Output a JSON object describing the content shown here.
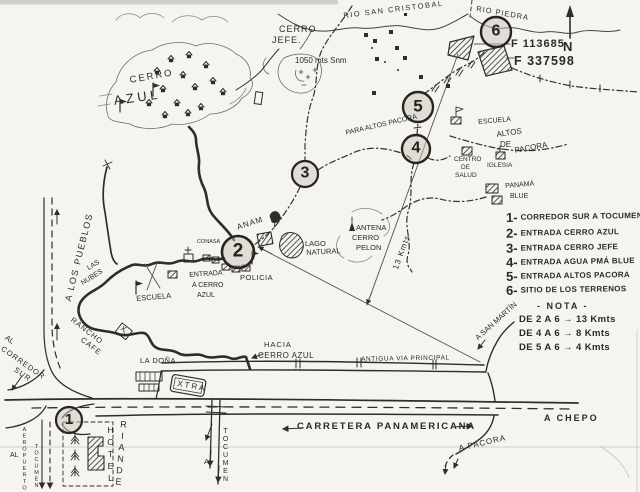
{
  "map": {
    "compass_n": "N",
    "rivers": {
      "rio_piedra": "RIO PIEDRA",
      "rio_san_cristobal": "RIO SAN CRISTOBAL"
    },
    "site": {
      "f1": "F 113685",
      "f2": "F 337598"
    },
    "markers": {
      "m1": "1",
      "m2": "2",
      "m3": "3",
      "m4": "4",
      "m5": "5",
      "m6": "6"
    },
    "places": {
      "cerro_jefe_1": "CERRO",
      "cerro_jefe_2": "JEFE.",
      "cerro_jefe_elev": "1050 mts Snm",
      "cerro_azul_1": "CERRO",
      "cerro_azul_2": "AZUL",
      "para_altos_pacora": "PARA ALTOS PACORA",
      "escuela_pacora": "ESCUELA",
      "altos_1": "ALTOS",
      "altos_2": "DE",
      "altos_3": "PACORA",
      "centro_1": "CENTRO",
      "centro_2": "DE",
      "centro_3": "SALUD",
      "iglesia": "IGLESIA",
      "panama_blue_1": "PANAMÁ",
      "panama_blue_2": "BLUE",
      "antena": "ANTENA",
      "cerro_pelon_1": "CERRO",
      "cerro_pelon_2": "PELON",
      "lago_1": "LAGO",
      "lago_2": "NATURAL",
      "anam": "ANAM",
      "conasa": "CONASA",
      "entrada_1": "ENTRADA",
      "entrada_2": "A CERRO",
      "entrada_3": "AZUL",
      "policia": "POLICIA",
      "las_nubes_1": "LAS",
      "las_nubes_2": "NUBES",
      "a_los_pueblos": "A LOS PUEBLOS",
      "rancho": "RANCHO",
      "cafe": "CAFE",
      "escuela_left": "ESCUELA",
      "hacia_1": "HACIA",
      "hacia_2": "CERRO AZUL",
      "antigua_via": "ANTIGUA VIA PRINCIPAL",
      "carretera": "CARRETERA PANAMERICANA",
      "la_dona": "LA DOÑA",
      "xtra": "XTRA",
      "a_san_martin": "A SAN MARTÍN",
      "a_chepo": "A CHEPO",
      "a_pacora": "A PACORA",
      "a_tocumen_a": "A",
      "a_tocumen": "TOCUMEN",
      "al_corredor_1": "AL",
      "al_corredor_2": "CORREDOR",
      "al_corredor_3": "SUR",
      "al_aeropuerto_1": "AL",
      "al_aeropuerto_2": "AEROPUERTO",
      "al_aeropuerto_3": "TOCUMEN",
      "hotel": "HOTEL",
      "riande": "RIANDE",
      "kmts13": "13 Kmts"
    },
    "legend": {
      "items": [
        {
          "n": "1-",
          "t": "CORREDOR SUR A TOCUMEN"
        },
        {
          "n": "2-",
          "t": "ENTRADA CERRO AZUL"
        },
        {
          "n": "3-",
          "t": "ENTRADA CERRO JEFE"
        },
        {
          "n": "4-",
          "t": "ENTRADA AGUA PMÁ BLUE"
        },
        {
          "n": "5-",
          "t": "ENTRADA ALTOS PACORA"
        },
        {
          "n": "6-",
          "t": "SITIO DE LOS TERRENOS"
        }
      ],
      "nota": "- NOTA -",
      "notes": [
        "DE 2 A 6 → 13 Kmts",
        "DE 4 A 6 → 8 Kmts",
        "DE 5 A 6 → 4 Kmts"
      ]
    }
  }
}
